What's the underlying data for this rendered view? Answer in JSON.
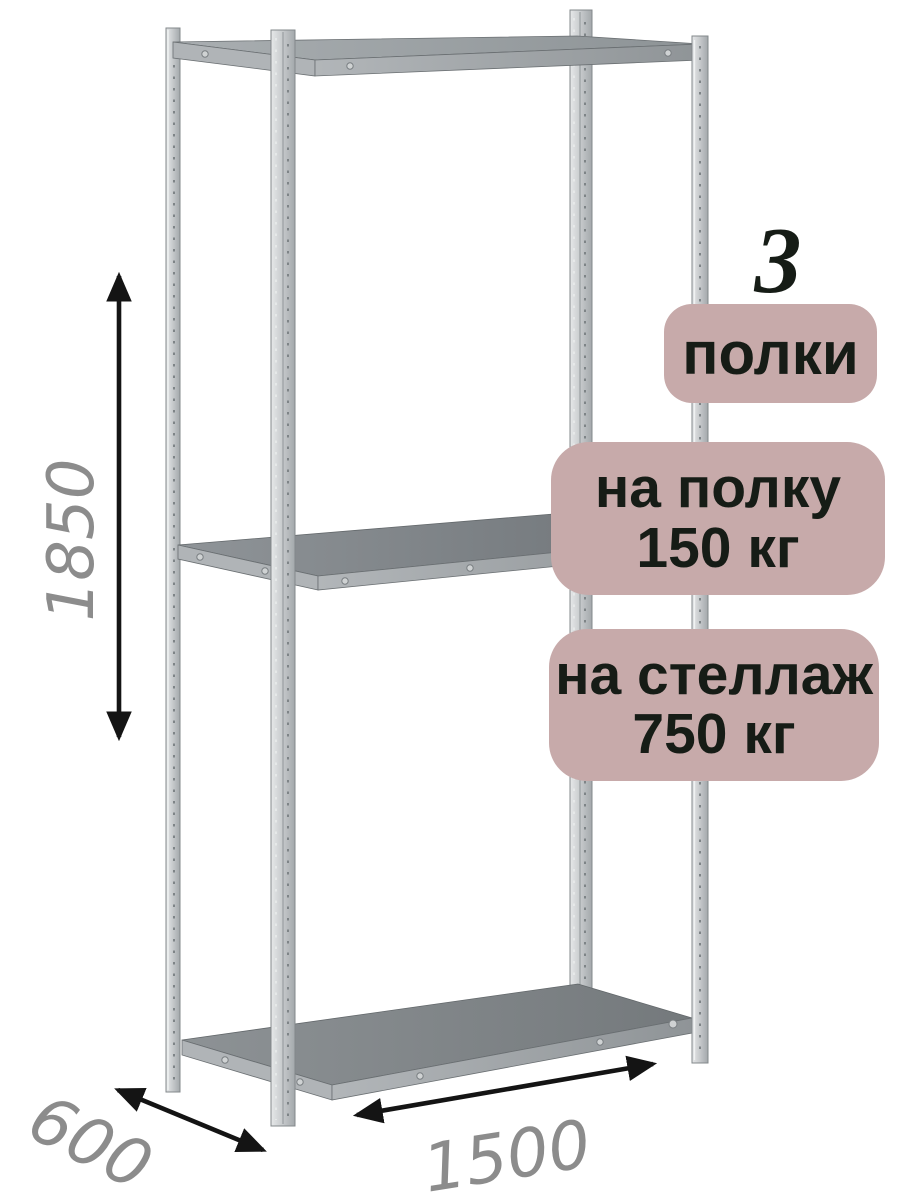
{
  "dimensions": {
    "height": "1850",
    "depth": "600",
    "width": "1500"
  },
  "badges": {
    "shelf_count": {
      "number": "3",
      "label": "полки"
    },
    "shelf_load": {
      "line1": "на полку",
      "line2": "150 кг"
    },
    "rack_load": {
      "line1": "на стеллаж",
      "line2": "750 кг"
    }
  },
  "colors": {
    "background": "#ffffff",
    "badge_background": "#c7aaaa",
    "badge_text": "#161c16",
    "dimension_text": "#8c8c8c",
    "arrow": "#141414",
    "metal_light": "#d6d9da",
    "metal_mid": "#b4b8bb",
    "shelf_surface": "#7e8387"
  }
}
